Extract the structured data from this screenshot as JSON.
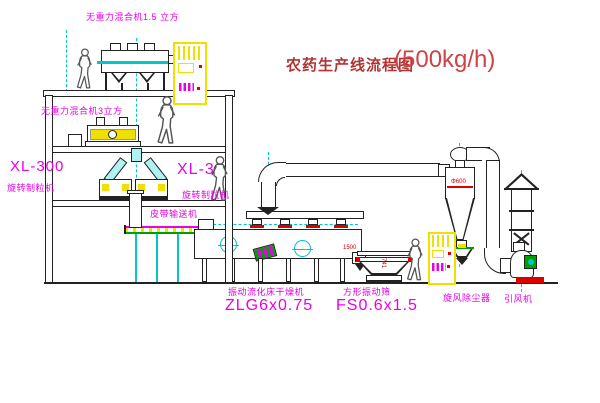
{
  "title": {
    "text": "农药生产线流程图",
    "capacity": "(500kg/h)"
  },
  "equipment_labels": {
    "mixer_top": "无重力混合机1.5 立方",
    "mixer_mid": "无重力混合机3立方",
    "granulator_model_left": "XL-300",
    "granulator_left": "旋转制粒机",
    "granulator_model_right": "XL-300",
    "granulator_right": "旋转制粒机",
    "belt_conveyor": "皮带输送机",
    "dryer": "振动流化床干燥机",
    "dryer_model": "ZLG6x0.75",
    "sieve": "方形振动筛",
    "sieve_model": "FS0.6x1.5",
    "cyclone": "旋风除尘器",
    "fan": "引风机"
  },
  "dimensions": {
    "sieve_length": "1500",
    "sieve_height": "741",
    "cyclone_dia": "Φ600"
  },
  "colors": {
    "label_magenta": "#E800E8",
    "equipment_yellow": "#F0E000",
    "centerline_cyan": "#00C8C8",
    "accent_red": "#DD0000",
    "accent_green": "#00A000",
    "title_red": "#B33333",
    "line_dark": "#222222"
  }
}
